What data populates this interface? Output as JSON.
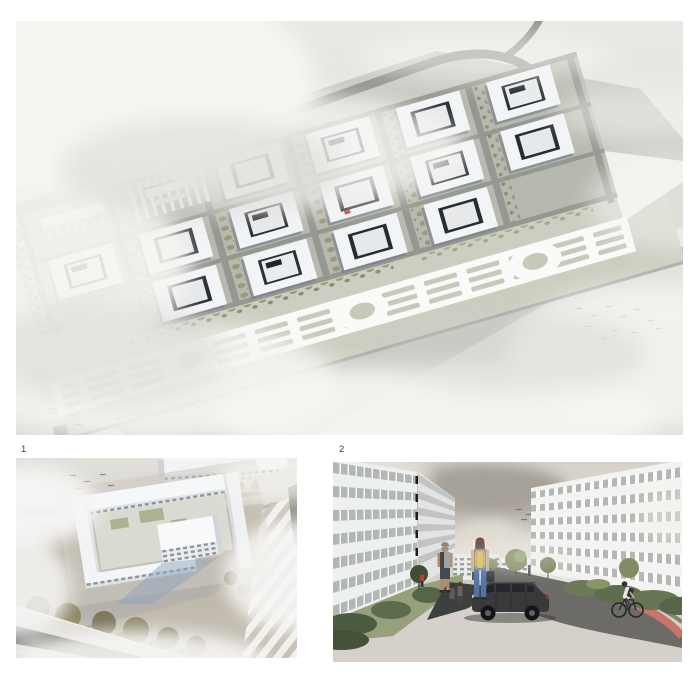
{
  "page": {
    "background": "#ffffff"
  },
  "labels": {
    "figure1": "1",
    "figure2": "2"
  },
  "colors": {
    "sky_grey": "#e7e6e2",
    "cloud_white": "#f6f5f2",
    "ground_sage": "#cbcfc1",
    "band_ground": "#b6b9af",
    "road_grey": "#959791",
    "roof_white": "#f3f4f6",
    "courtyard_dark": "#262c33",
    "facade_blue": "#78828b",
    "tree_olive": "#9e9678",
    "entrance_red": "#c23b2f",
    "asphalt_dark": "#6c6b67",
    "bike_lane_red": "#c7746a",
    "shrub_green": "#5d6c4c",
    "backpack_yellow": "#d9b94b",
    "denim_blue": "#5274a3",
    "suv_charcoal": "#37393b"
  }
}
